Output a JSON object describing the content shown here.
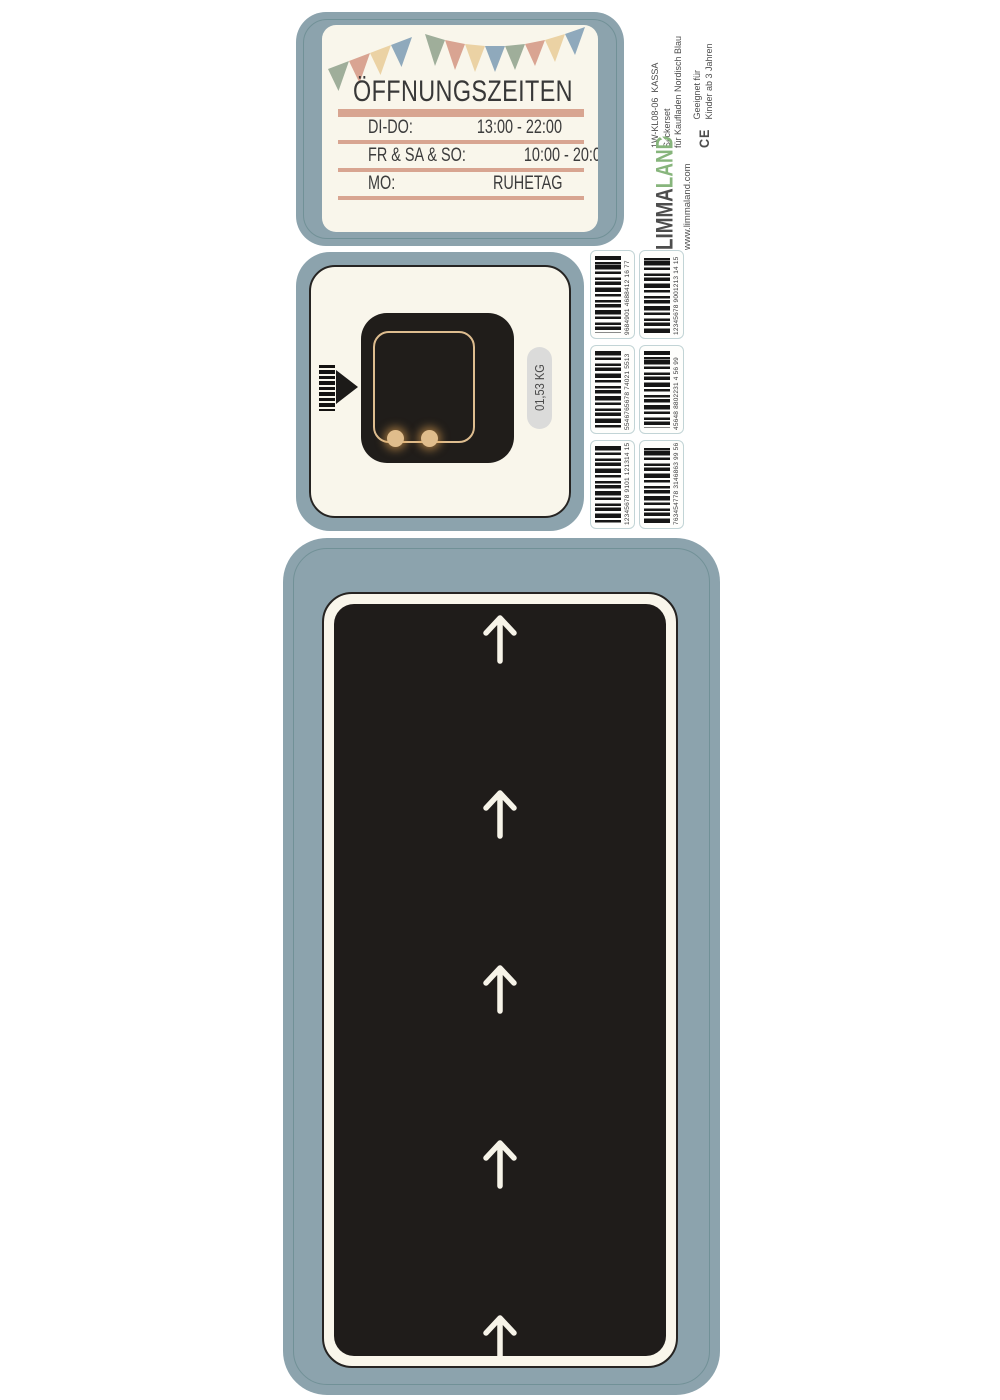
{
  "sheet": {
    "product_code": "1W-KL08-06",
    "product_name": "KASSA Stickerset",
    "product_subtitle": "für Kaufladen Nordisch Blau",
    "ce_mark": "CE",
    "age_note_line1": "Geeignet für",
    "age_note_line2": "Kinder ab 3 Jahren",
    "brand_part1": "LIMMA",
    "brand_part2": "LAND",
    "website": "www.limmaland.com"
  },
  "opening_hours_sign": {
    "title": "ÖFFNUNGSZEITEN",
    "rows": [
      {
        "label": "DI-DO:",
        "value": "13:00 - 22:00"
      },
      {
        "label": "FR & SA & SO:",
        "value": "10:00 - 20:00"
      },
      {
        "label": "MO:",
        "value": "RUHETAG"
      }
    ]
  },
  "scale_sticker": {
    "weight_display": "01,53 KG"
  },
  "barcode_stickers": [
    {
      "number": "9684901 4688412 16 77"
    },
    {
      "number": "12345678 9001213 14 15"
    },
    {
      "number": "5546765678 74021 5513"
    },
    {
      "number": "45648 8802231 4 56 99"
    },
    {
      "number": "12345678 9101 121314 15"
    },
    {
      "number": "763454778 3146863 99 56"
    }
  ],
  "colors": {
    "card_blue": "#8CA3AD",
    "cream": "#F9F6EB",
    "belt_black": "#1F1C1A",
    "salmon_line": "#D8A591",
    "brand_green": "#87B57C",
    "tan_accent": "#DEBD8F",
    "flag_palette": [
      "#9FAE9A",
      "#D9A492",
      "#EBD2A4",
      "#8FA9BC"
    ]
  }
}
